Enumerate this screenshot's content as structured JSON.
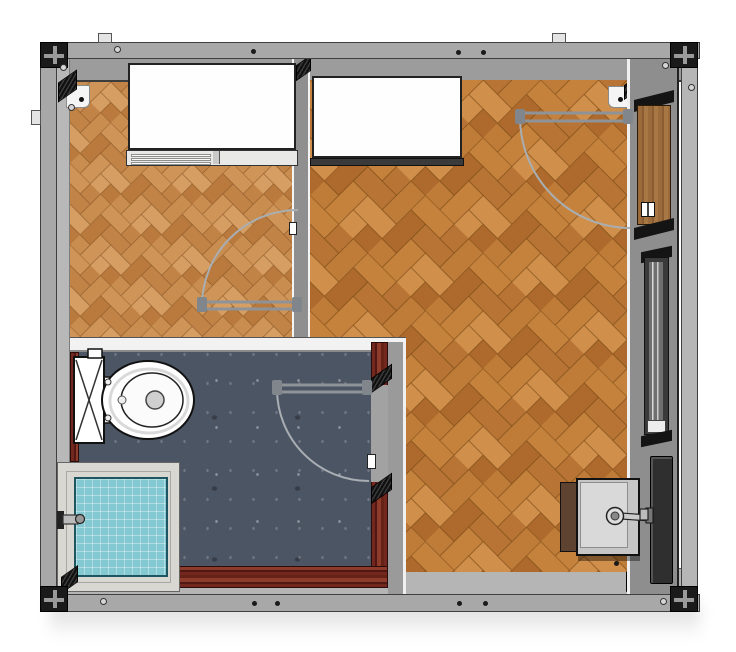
{
  "scene": {
    "kind": "3d-floor-plan-render",
    "view": "top-down",
    "background": "#ffffff",
    "visible_text": []
  },
  "palette": {
    "frame_gray": "#a8a8a8",
    "wall_gray": "#8e8e8e",
    "corner_fitting_black": "#1a1a1a",
    "wood_floor_light": "#cf9457",
    "wood_floor_dark": "#bd7a36",
    "slate_floor": "#4c5564",
    "maroon_wall": "#72281f",
    "shower_tile_blue": "#84c8d2",
    "shower_tray_gray": "#d8d7d1",
    "door_leaf_wood": "#9c6b3c",
    "fixture_white": "#ffffff",
    "door_symbol_gray": "#a9aeb2"
  },
  "structure": {
    "frame": {
      "type": "steel-container-frame",
      "corner_fittings": 4,
      "bolt_marks": 6,
      "screw_marks": 6
    },
    "rooms": [
      {
        "id": "room-left",
        "floor": "herringbone-parquet-light",
        "contents": [
          "wall-cabinet"
        ]
      },
      {
        "id": "room-right",
        "floor": "herringbone-parquet",
        "contents": [
          "wall-cabinet",
          "wash-basin"
        ]
      },
      {
        "id": "bathroom",
        "floor": "slate",
        "contents": [
          "toilet",
          "shower-tray",
          "shower-valve"
        ]
      }
    ]
  },
  "fixtures": [
    {
      "name": "wall-cabinet-left",
      "room": "room-left"
    },
    {
      "name": "wall-cabinet-right",
      "room": "room-right"
    },
    {
      "name": "toilet",
      "room": "bathroom",
      "cistern_mark": "X"
    },
    {
      "name": "shower-tray",
      "room": "bathroom",
      "tiled": true
    },
    {
      "name": "shower-valve",
      "room": "bathroom"
    },
    {
      "name": "wash-basin",
      "room": "room-right",
      "has_faucet": true
    },
    {
      "name": "window",
      "location": "right-wall",
      "sill": true
    },
    {
      "name": "storage-slab",
      "location": "right-wall"
    }
  ],
  "doors": [
    {
      "name": "entry-door",
      "location": "right-wall-top",
      "leaf": "wood",
      "swing_symbol": true
    },
    {
      "name": "room-divider-door",
      "location": "middle-wall",
      "swing_symbol": true
    },
    {
      "name": "bathroom-door",
      "location": "bathroom-right-wall",
      "swing_symbol": true
    }
  ]
}
